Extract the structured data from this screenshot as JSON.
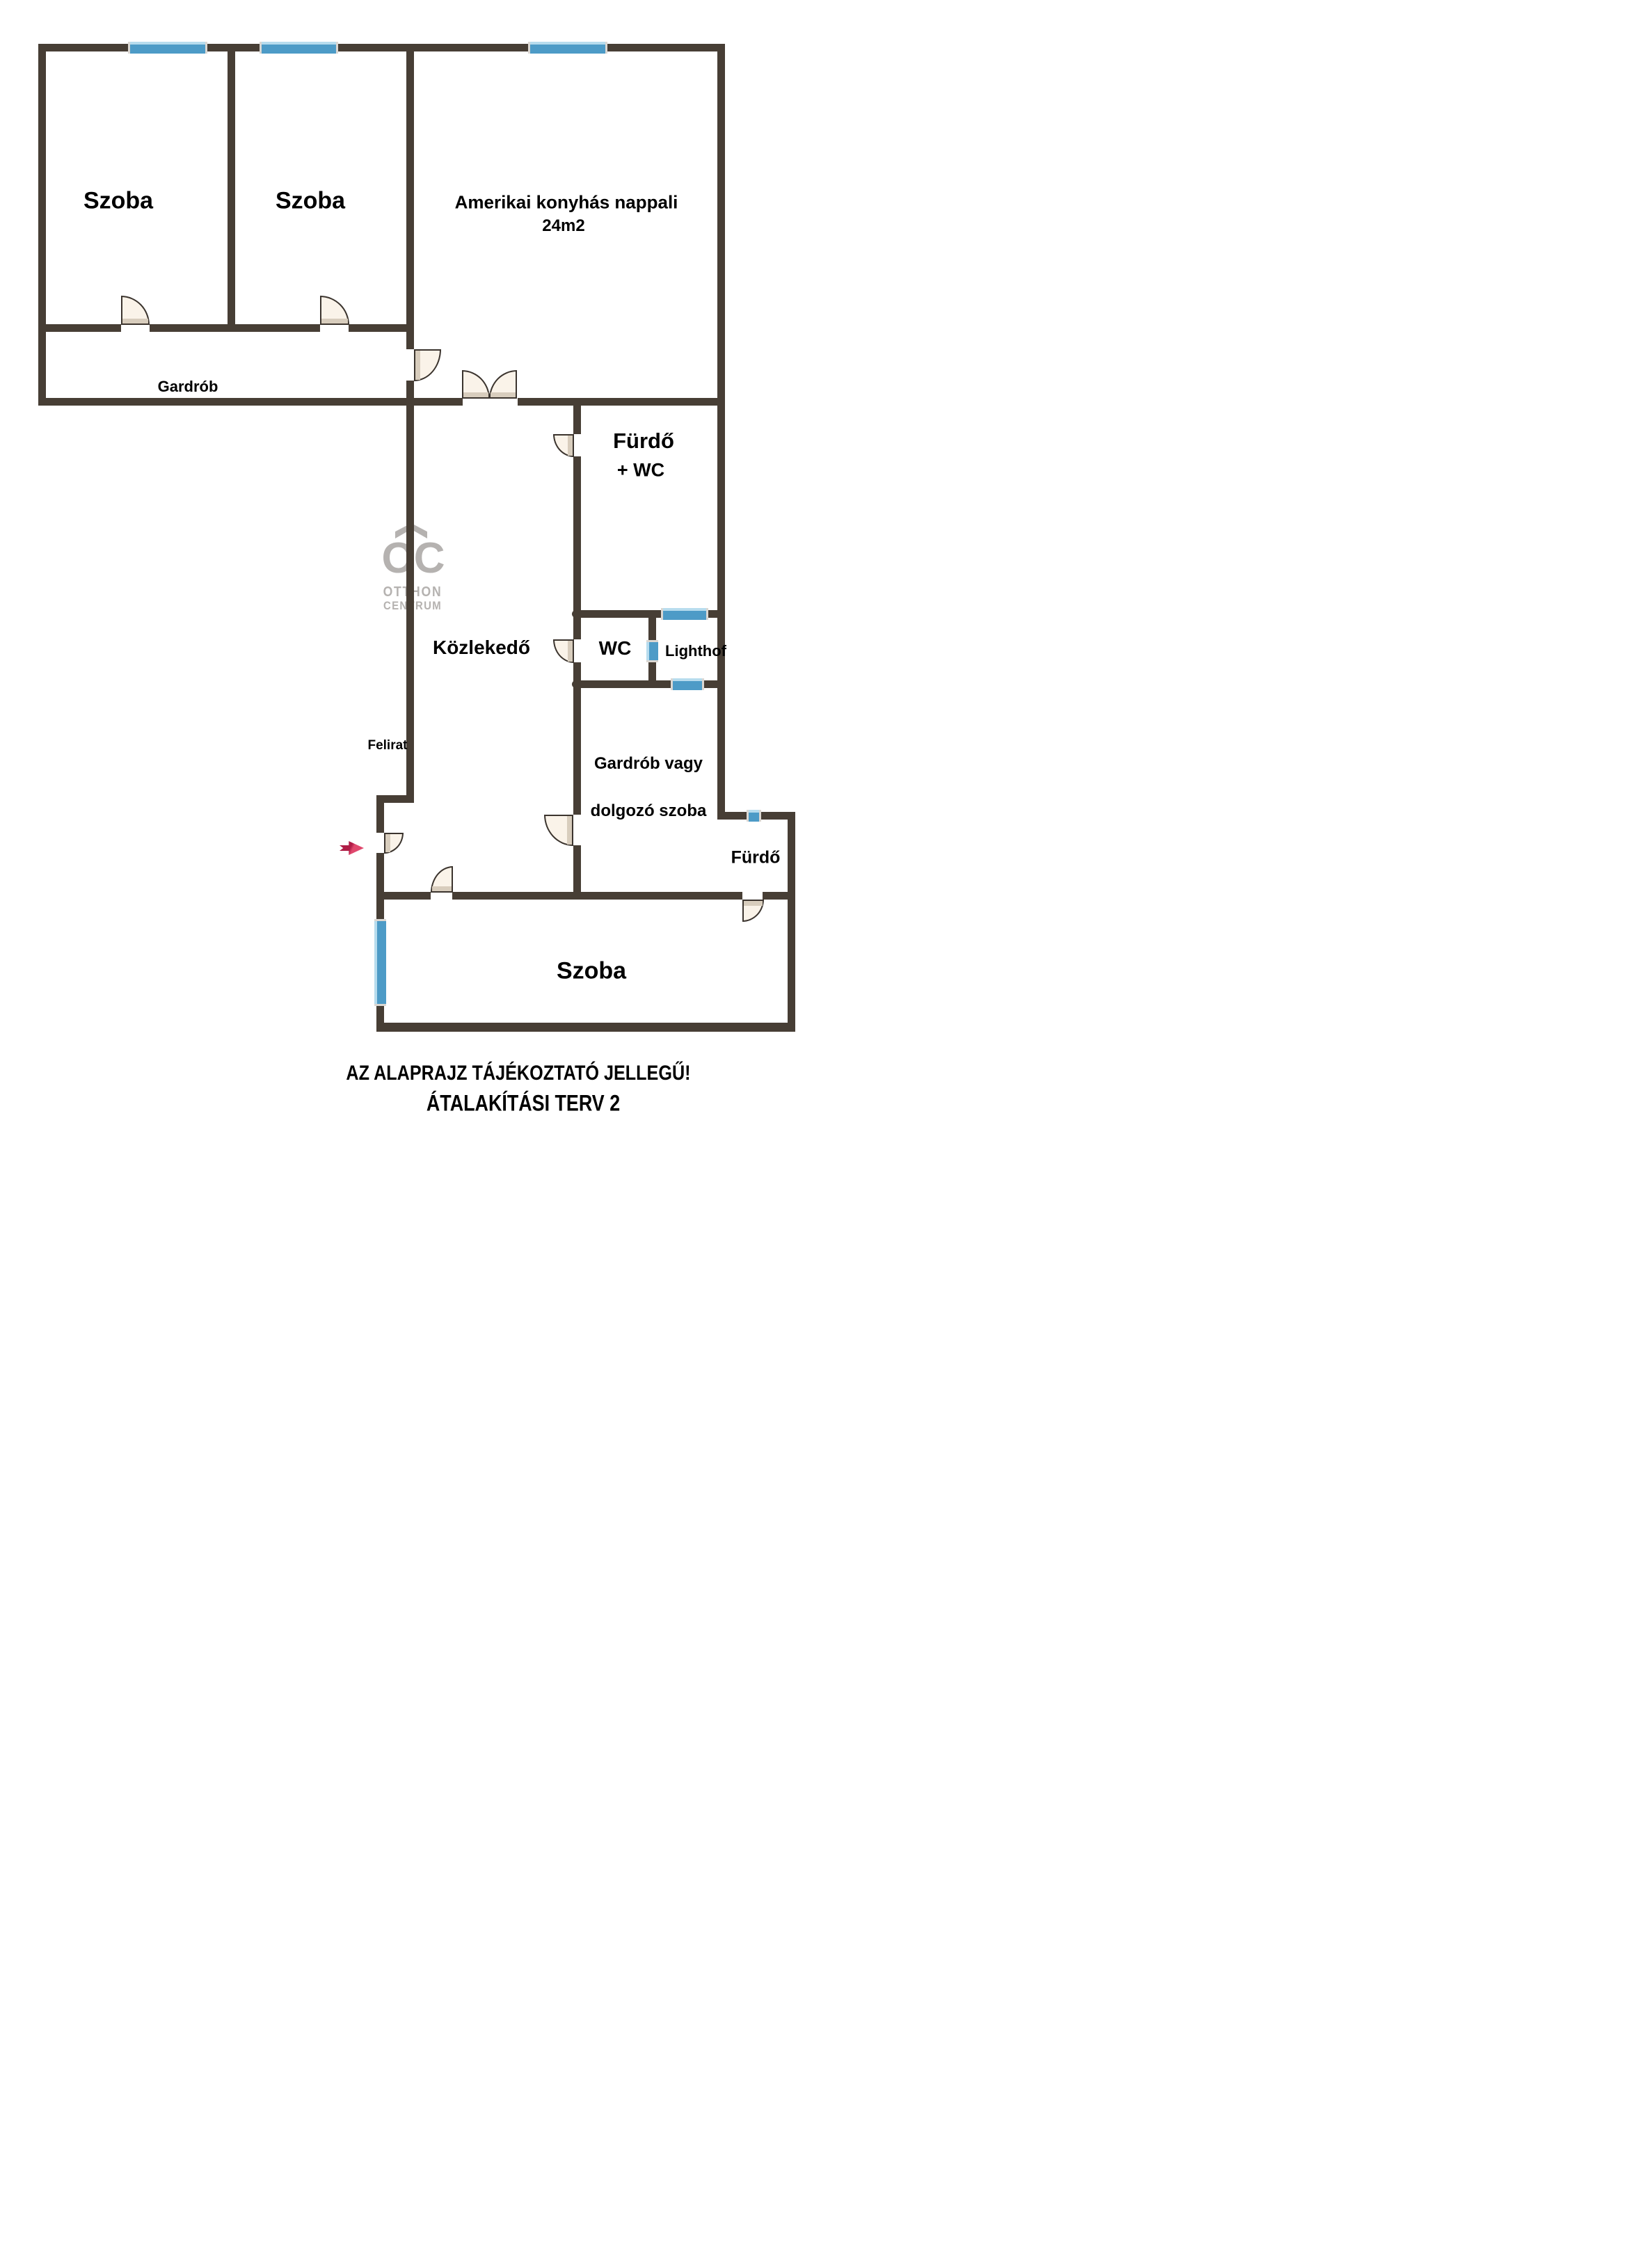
{
  "watermark": {
    "monogram": "OC",
    "line1": "OTTHON",
    "line2": "CENTRUM"
  },
  "rooms": {
    "szoba1": {
      "label": "Szoba"
    },
    "szoba2": {
      "label": "Szoba"
    },
    "nappali": {
      "label": "Amerikai konyhás nappali",
      "area": "24m2"
    },
    "gardrob": {
      "label": "Gardrób"
    },
    "furdo_wc": {
      "label": "Fürdő",
      "label2": "+ WC"
    },
    "kozlekedo": {
      "label": "Közlekedő"
    },
    "wc": {
      "label": "WC"
    },
    "lighthof": {
      "label": "Lighthof"
    },
    "felirat": {
      "label": "Felirat"
    },
    "gardrob_dolgozo": {
      "label": "Gardrób vagy",
      "label2": "dolgozó szoba"
    },
    "furdo2": {
      "label": "Fürdő"
    },
    "szoba3": {
      "label": "Szoba"
    }
  },
  "captions": {
    "line1": "AZ ALAPRAJZ TÁJÉKOZTATÓ JELLEGŰ!",
    "line2": "ÁTALAKÍTÁSI TERV 2"
  },
  "colors": {
    "wall": "#473E35",
    "line": "#3B342E",
    "window": "#4D9BC7",
    "windowLight": "#B7DCEE",
    "windowCap": "#DBD7D2",
    "door": "#FAF3E9",
    "doorLeaf": "#D8CDBD",
    "logo": "#B5B2B0",
    "arrowDark": "#B01D47",
    "arrowLight": "#E0486D"
  }
}
